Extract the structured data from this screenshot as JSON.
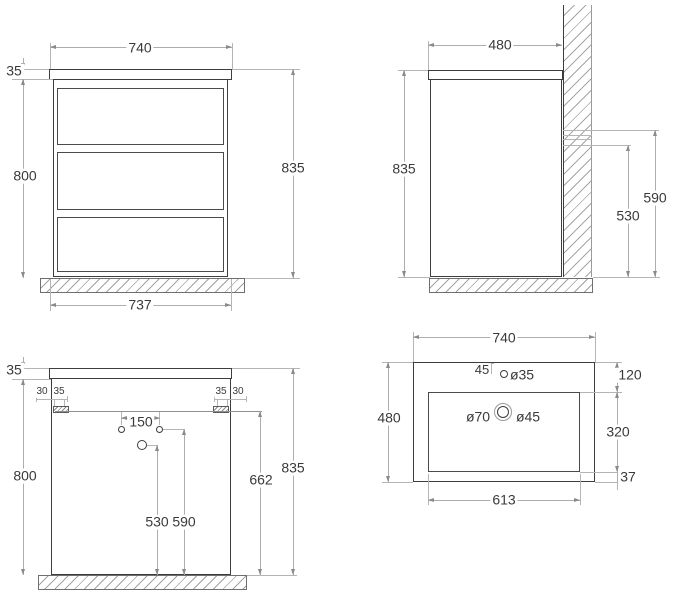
{
  "front": {
    "width_top": "740",
    "top_thickness": "35",
    "body_height": "800",
    "total_height": "835",
    "width_bottom": "737"
  },
  "side": {
    "depth": "480",
    "total_height": "835",
    "outlet_top_height": "590",
    "outlet_bottom_height": "530"
  },
  "rear": {
    "top_thickness": "35",
    "body_height": "800",
    "total_height": "835",
    "bracket_line_height": "662",
    "left_offset": "30",
    "left_bracket_width": "35",
    "right_bracket_width": "35",
    "right_offset": "30",
    "holes_spacing": "150",
    "siphon_hole_height": "530",
    "outlet_holes_height": "590"
  },
  "sink": {
    "width": "740",
    "depth": "480",
    "faucet_edge_offset": "45",
    "faucet_hole_dia": "ø35",
    "drain_outer_dia": "ø70",
    "drain_inner_dia": "ø45",
    "back_rim": "120",
    "basin_depth": "320",
    "front_rim": "37",
    "basin_width": "613"
  },
  "colors": {
    "object_line": "#3d3d3d",
    "dimension_line": "#adadad",
    "hatch_line": "#a2a2a2",
    "text": "#3a3a3a",
    "background": "#ffffff"
  }
}
